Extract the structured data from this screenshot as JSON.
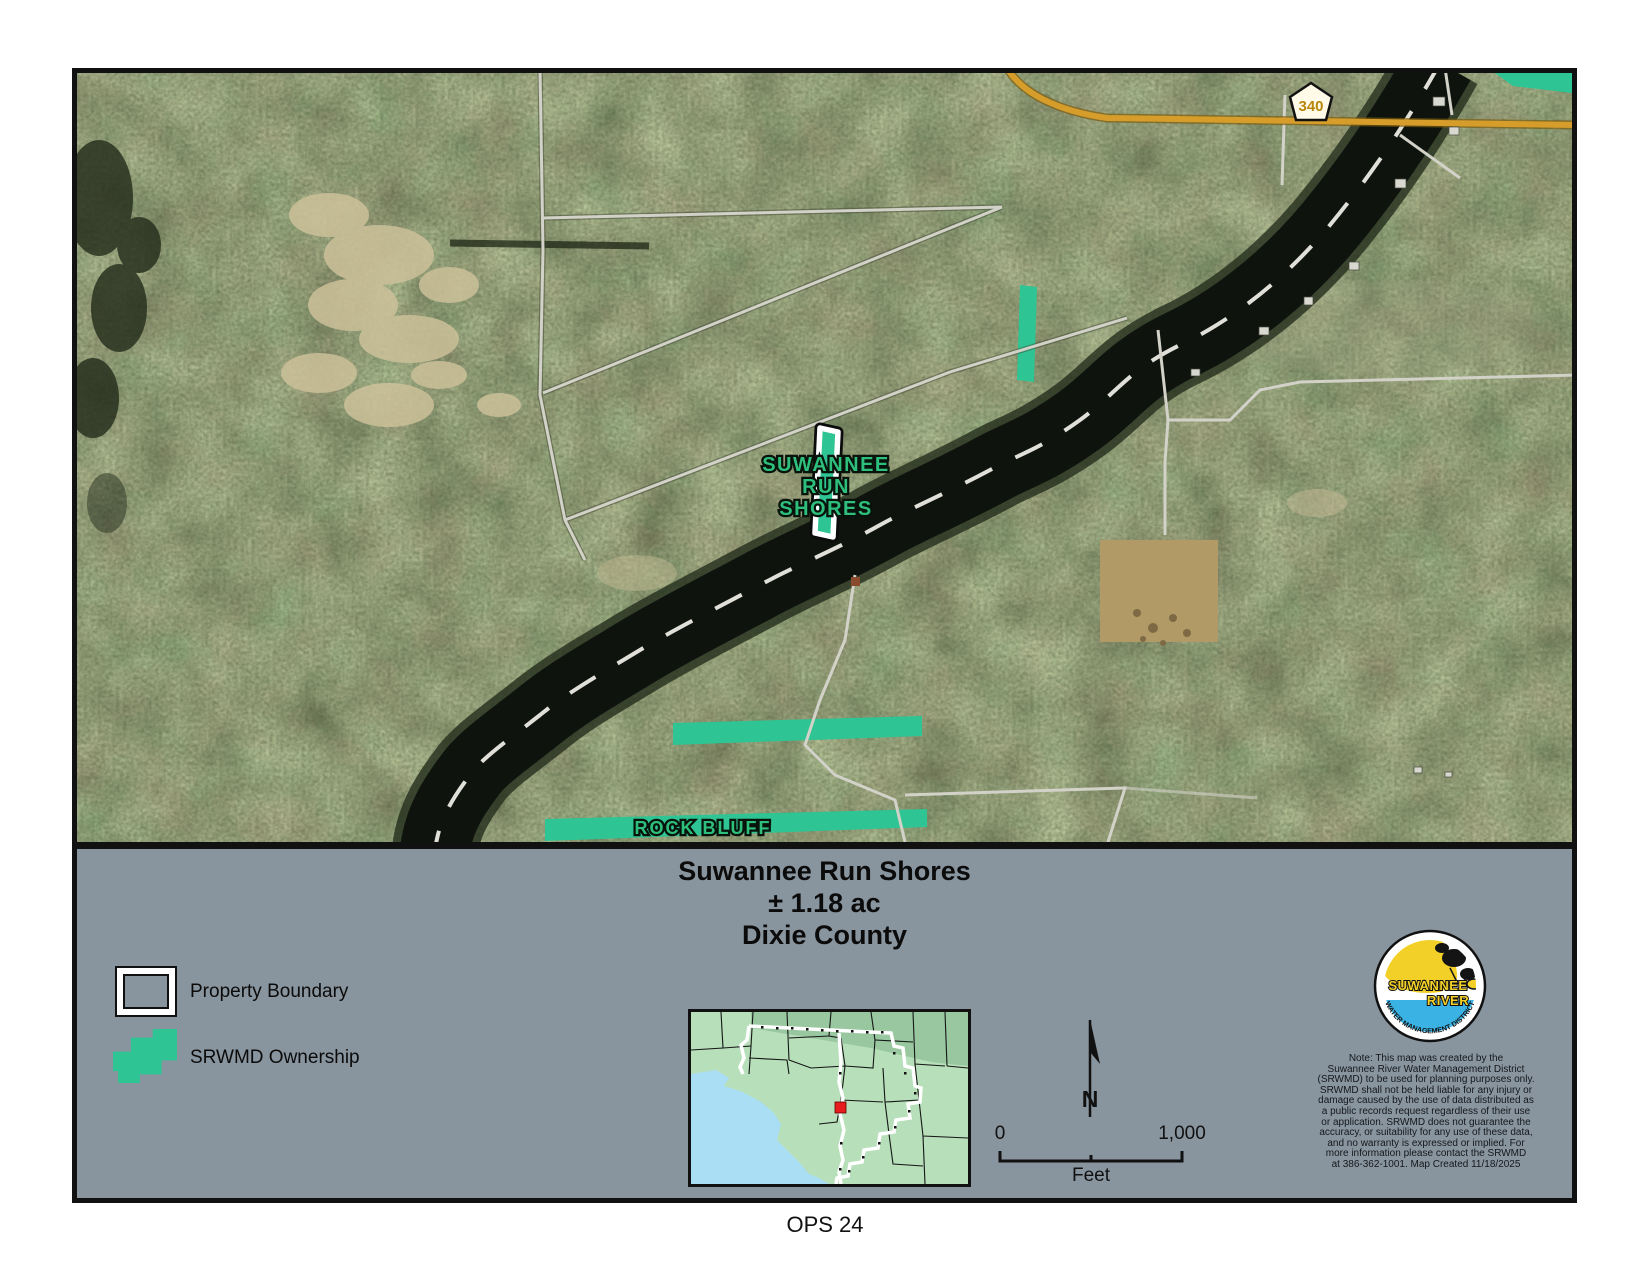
{
  "map": {
    "road_shield": "340",
    "property_label_lines": [
      "SUWANNEE",
      "RUN",
      "SHORES"
    ],
    "rock_bluff_label": "ROCK BLUFF"
  },
  "panel": {
    "title_line1": "Suwannee Run Shores",
    "title_line2": "± 1.18 ac",
    "title_line3": "Dixie County",
    "legend": {
      "property_boundary": "Property Boundary",
      "srwmd_ownership": "SRWMD Ownership"
    },
    "north_label": "N",
    "scale_bar": {
      "start": "0",
      "end": "1,000",
      "unit": "Feet"
    },
    "logo": {
      "line1": "SUWANNEE",
      "line2": "RIVER",
      "arc": "WATER MANAGEMENT DISTRICT"
    },
    "note": "Note: This map was created by the\nSuwannee River Water Management District\n(SRWMD) to be used for planning purposes only.\nSRWMD shall not be held liable for any injury or\ndamage caused by the use of data distributed as\na public records request regardless of their use\nor application. SRWMD does not guarantee the\naccuracy, or suitability for any use of these data,\nand no warranty is expressed or implied. For\nmore information please contact the SRWMD\nat 386-362-1001. Map Created 11/18/2025"
  },
  "footer": {
    "label": "OPS 24"
  },
  "colors": {
    "srwmd_green": "#2fc493",
    "label_green": "#2ebf7d",
    "panel_gray": "#88949e",
    "road_orange": "#d79d2b",
    "river_dark": "#0e130e",
    "inset_land": "#b7dfb9",
    "inset_water": "#a9def5",
    "marker_red": "#e81c1c",
    "logo_yellow": "#f2d028",
    "logo_blue": "#3ab2e4"
  }
}
